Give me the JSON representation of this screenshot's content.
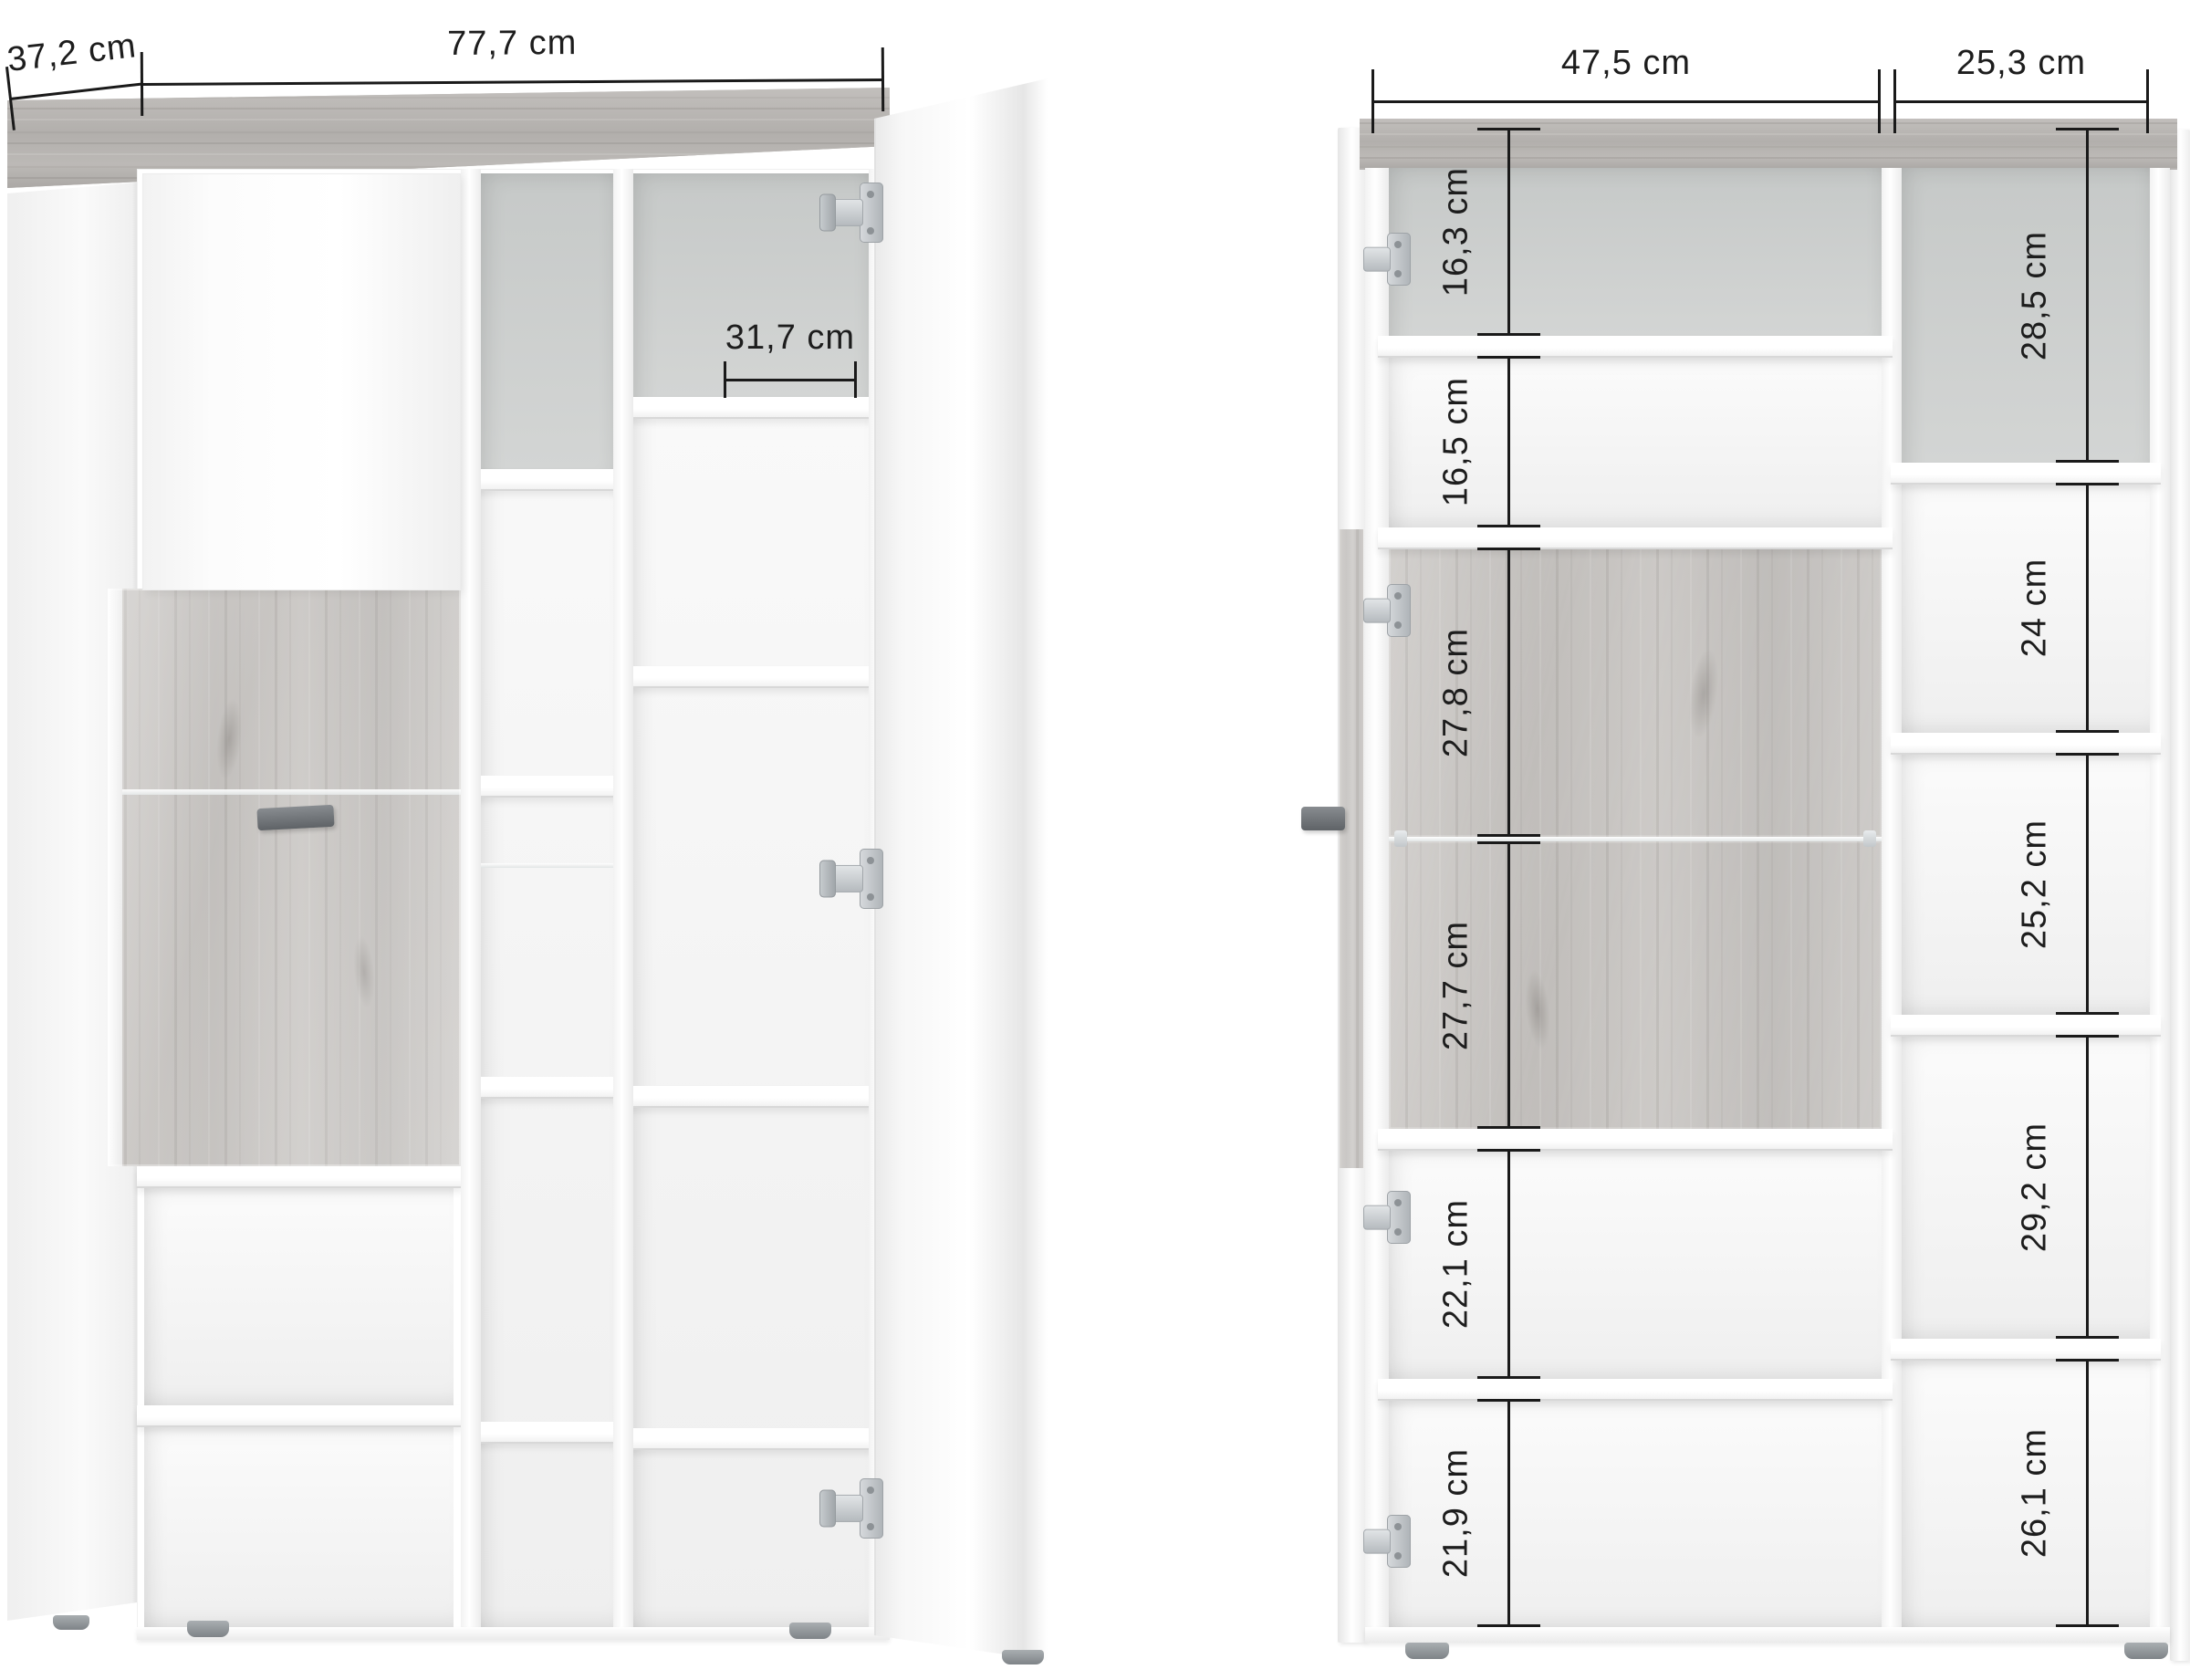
{
  "left_view": {
    "depth_label": "37,2 cm",
    "width_label": "77,7 cm",
    "inner_width_label": "31,7 cm"
  },
  "right_view": {
    "left_width_label": "47,5 cm",
    "right_width_label": "25,3 cm",
    "left_column_heights": [
      "16,3 cm",
      "16,5 cm",
      "27,8 cm",
      "27,7 cm",
      "22,1 cm",
      "21,9 cm"
    ],
    "right_column_heights": [
      "28,5 cm",
      "24 cm",
      "25,2 cm",
      "29,2 cm",
      "26,1 cm"
    ]
  },
  "colors": {
    "dimension_line": "#1a1a1a",
    "wood": "#c5c2bf",
    "wood_top": "#b8b5b2",
    "back_panel": "#c9cccb",
    "handle": "#6e7276",
    "foot": "#8f9498"
  }
}
